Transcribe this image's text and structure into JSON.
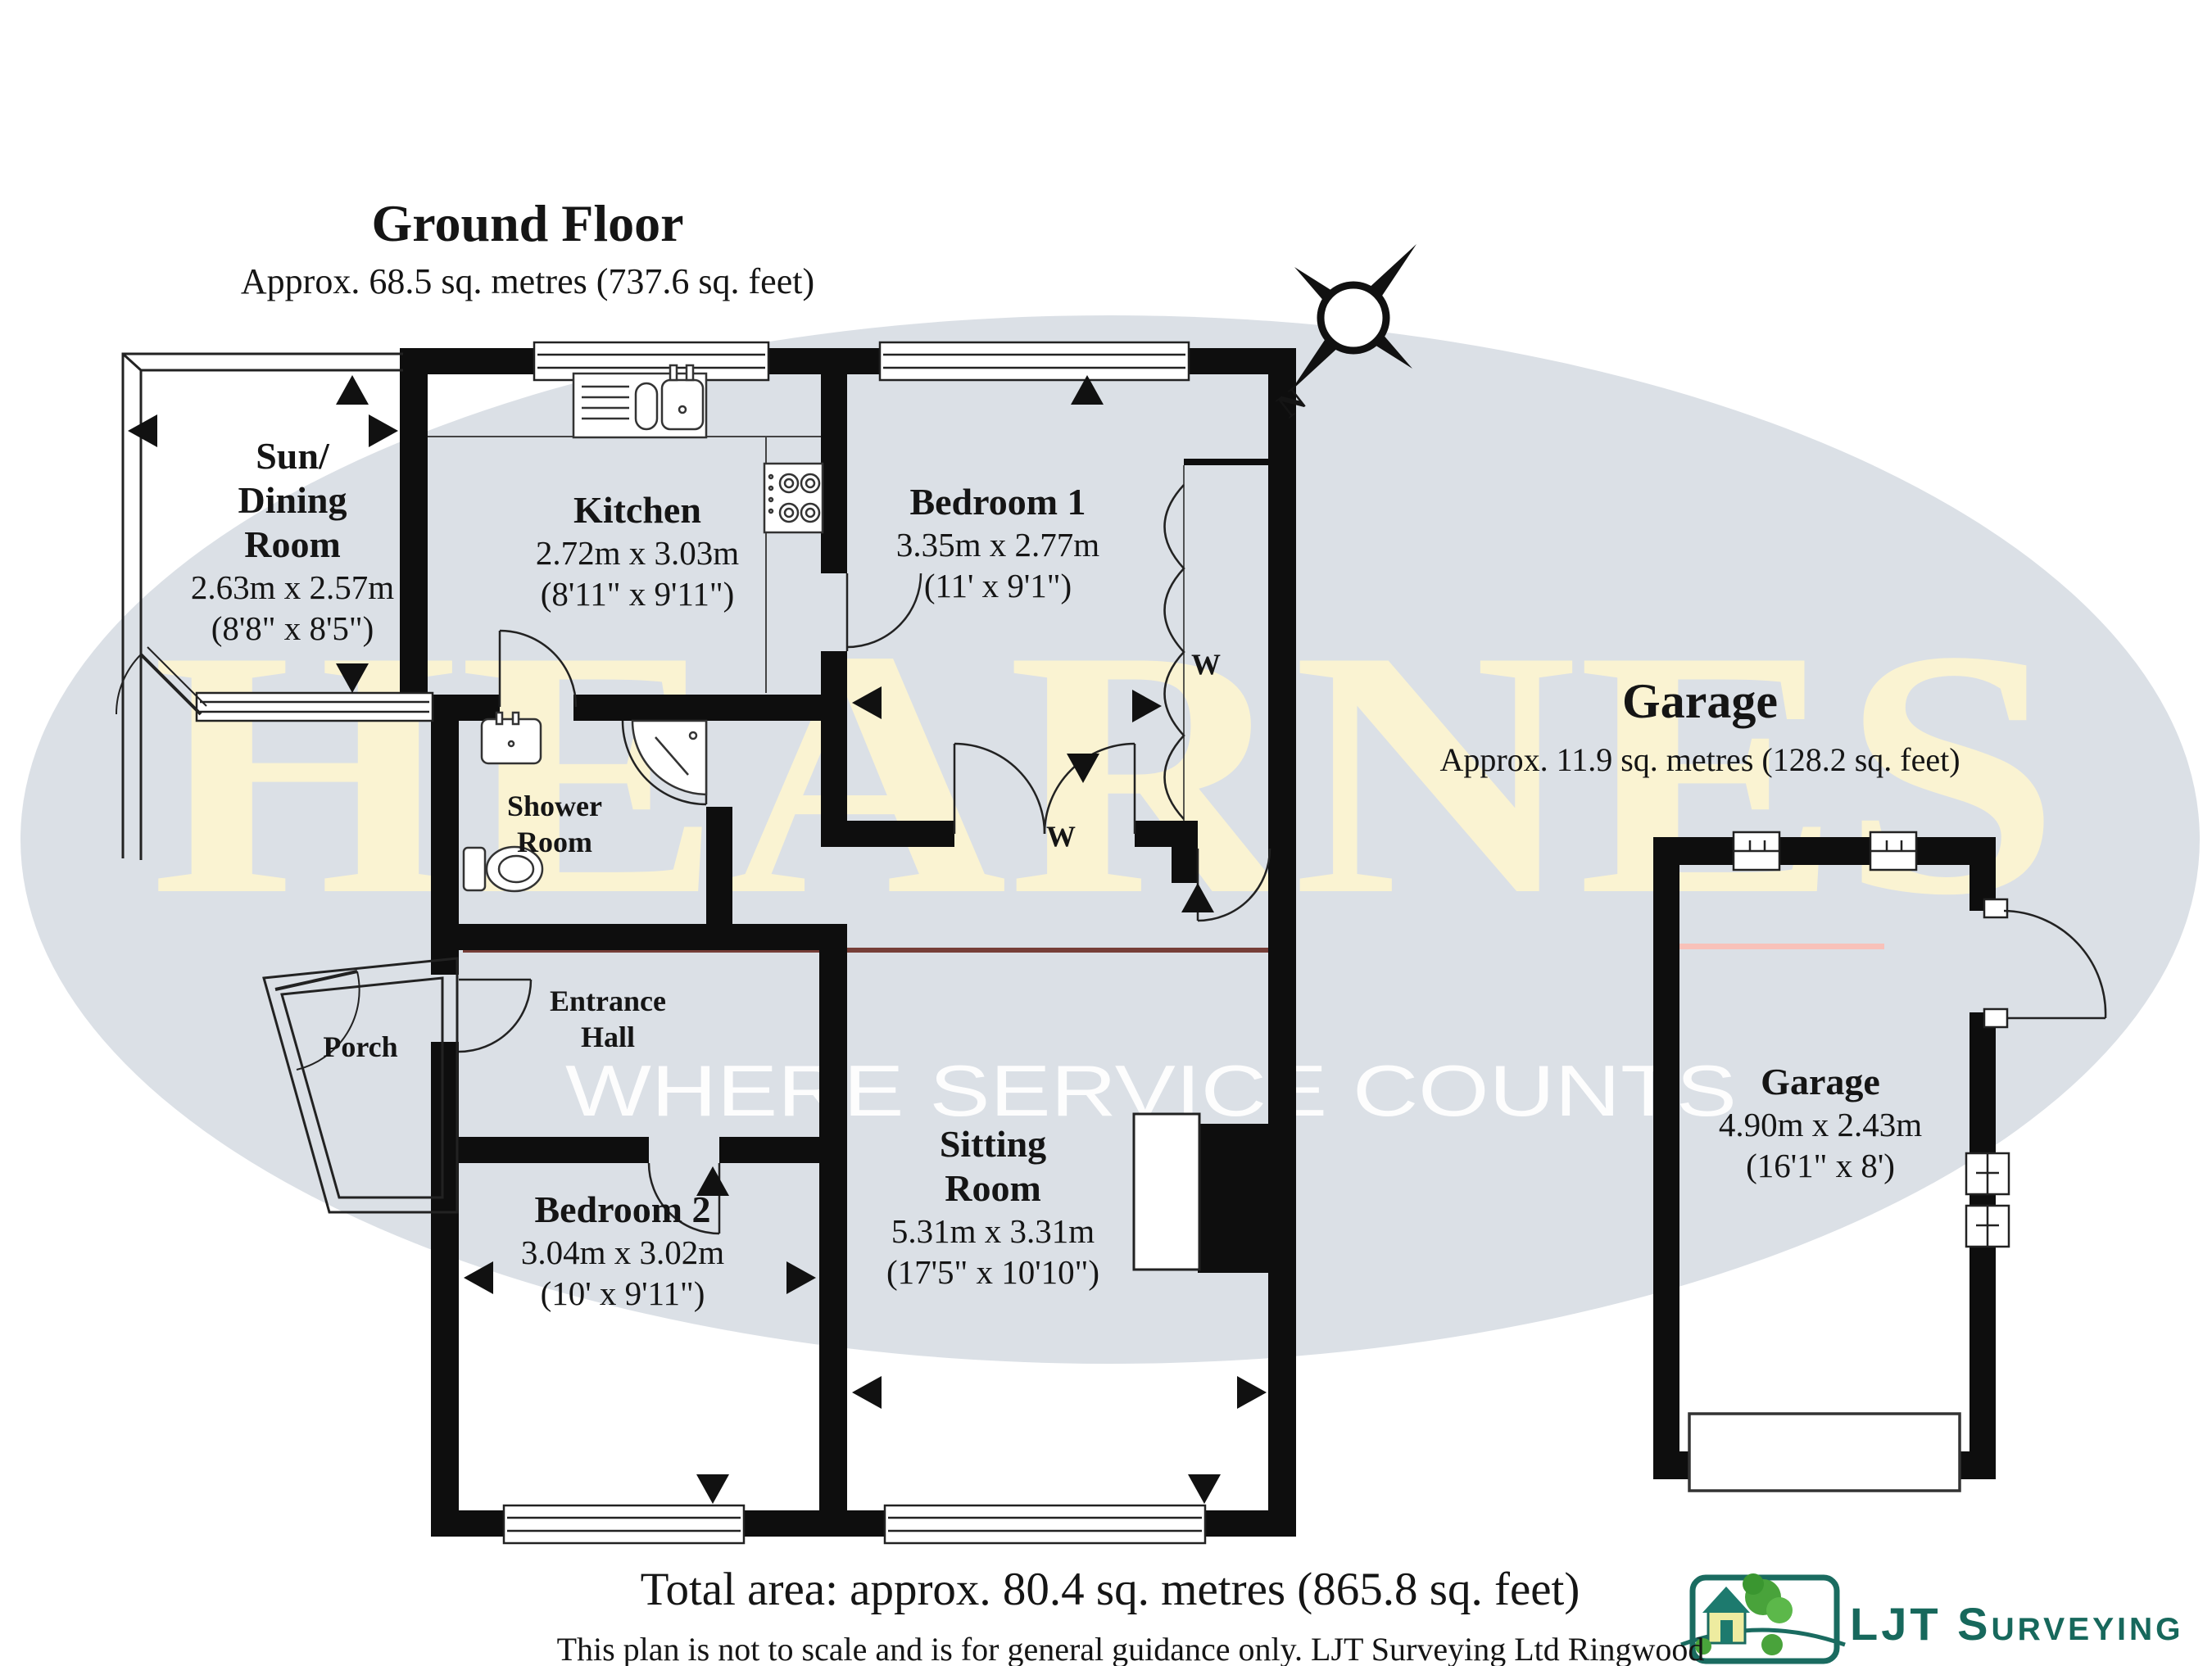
{
  "header": {
    "title": "Ground Floor",
    "subtitle": "Approx. 68.5 sq. metres (737.6 sq. feet)"
  },
  "garage_section": {
    "title": "Garage",
    "subtitle": "Approx. 11.9 sq. metres (128.2 sq. feet)"
  },
  "watermark": {
    "brand": "HEARNES",
    "tagline": "WHERE SERVICE COUNTS",
    "ellipse_color": "#dbe0e6",
    "brand_color": "#faf3d2"
  },
  "compass": {
    "north_label": "N"
  },
  "rooms": {
    "sun": {
      "n1": "Sun/",
      "n2": "Dining",
      "n3": "Room",
      "m": "2.63m x 2.57m",
      "i": "(8'8\" x 8'5\")"
    },
    "kitchen": {
      "n": "Kitchen",
      "m": "2.72m x 3.03m",
      "i": "(8'11\" x 9'11\")"
    },
    "bed1": {
      "n": "Bedroom 1",
      "m": "3.35m x 2.77m",
      "i": "(11' x 9'1\")"
    },
    "shower": {
      "n1": "Shower",
      "n2": "Room"
    },
    "hall": {
      "n1": "Entrance",
      "n2": "Hall"
    },
    "porch": {
      "n": "Porch"
    },
    "bed2": {
      "n": "Bedroom 2",
      "m": "3.04m x 3.02m",
      "i": "(10' x 9'11\")"
    },
    "sitting": {
      "n1": "Sitting",
      "n2": "Room",
      "m": "5.31m x 3.31m",
      "i": "(17'5\" x 10'10\")"
    },
    "garage": {
      "n": "Garage",
      "m": "4.90m x 2.43m",
      "i": "(16'1\" x 8')"
    }
  },
  "wardrobe": {
    "label": "W"
  },
  "footer": {
    "total": "Total area: approx. 80.4 sq. metres (865.8 sq. feet)",
    "disclaimer": "This plan is not to scale and is for general guidance only. LJT Surveying Ltd Ringwood"
  },
  "logo": {
    "name": "LJT Surveying",
    "color": "#17685c"
  }
}
